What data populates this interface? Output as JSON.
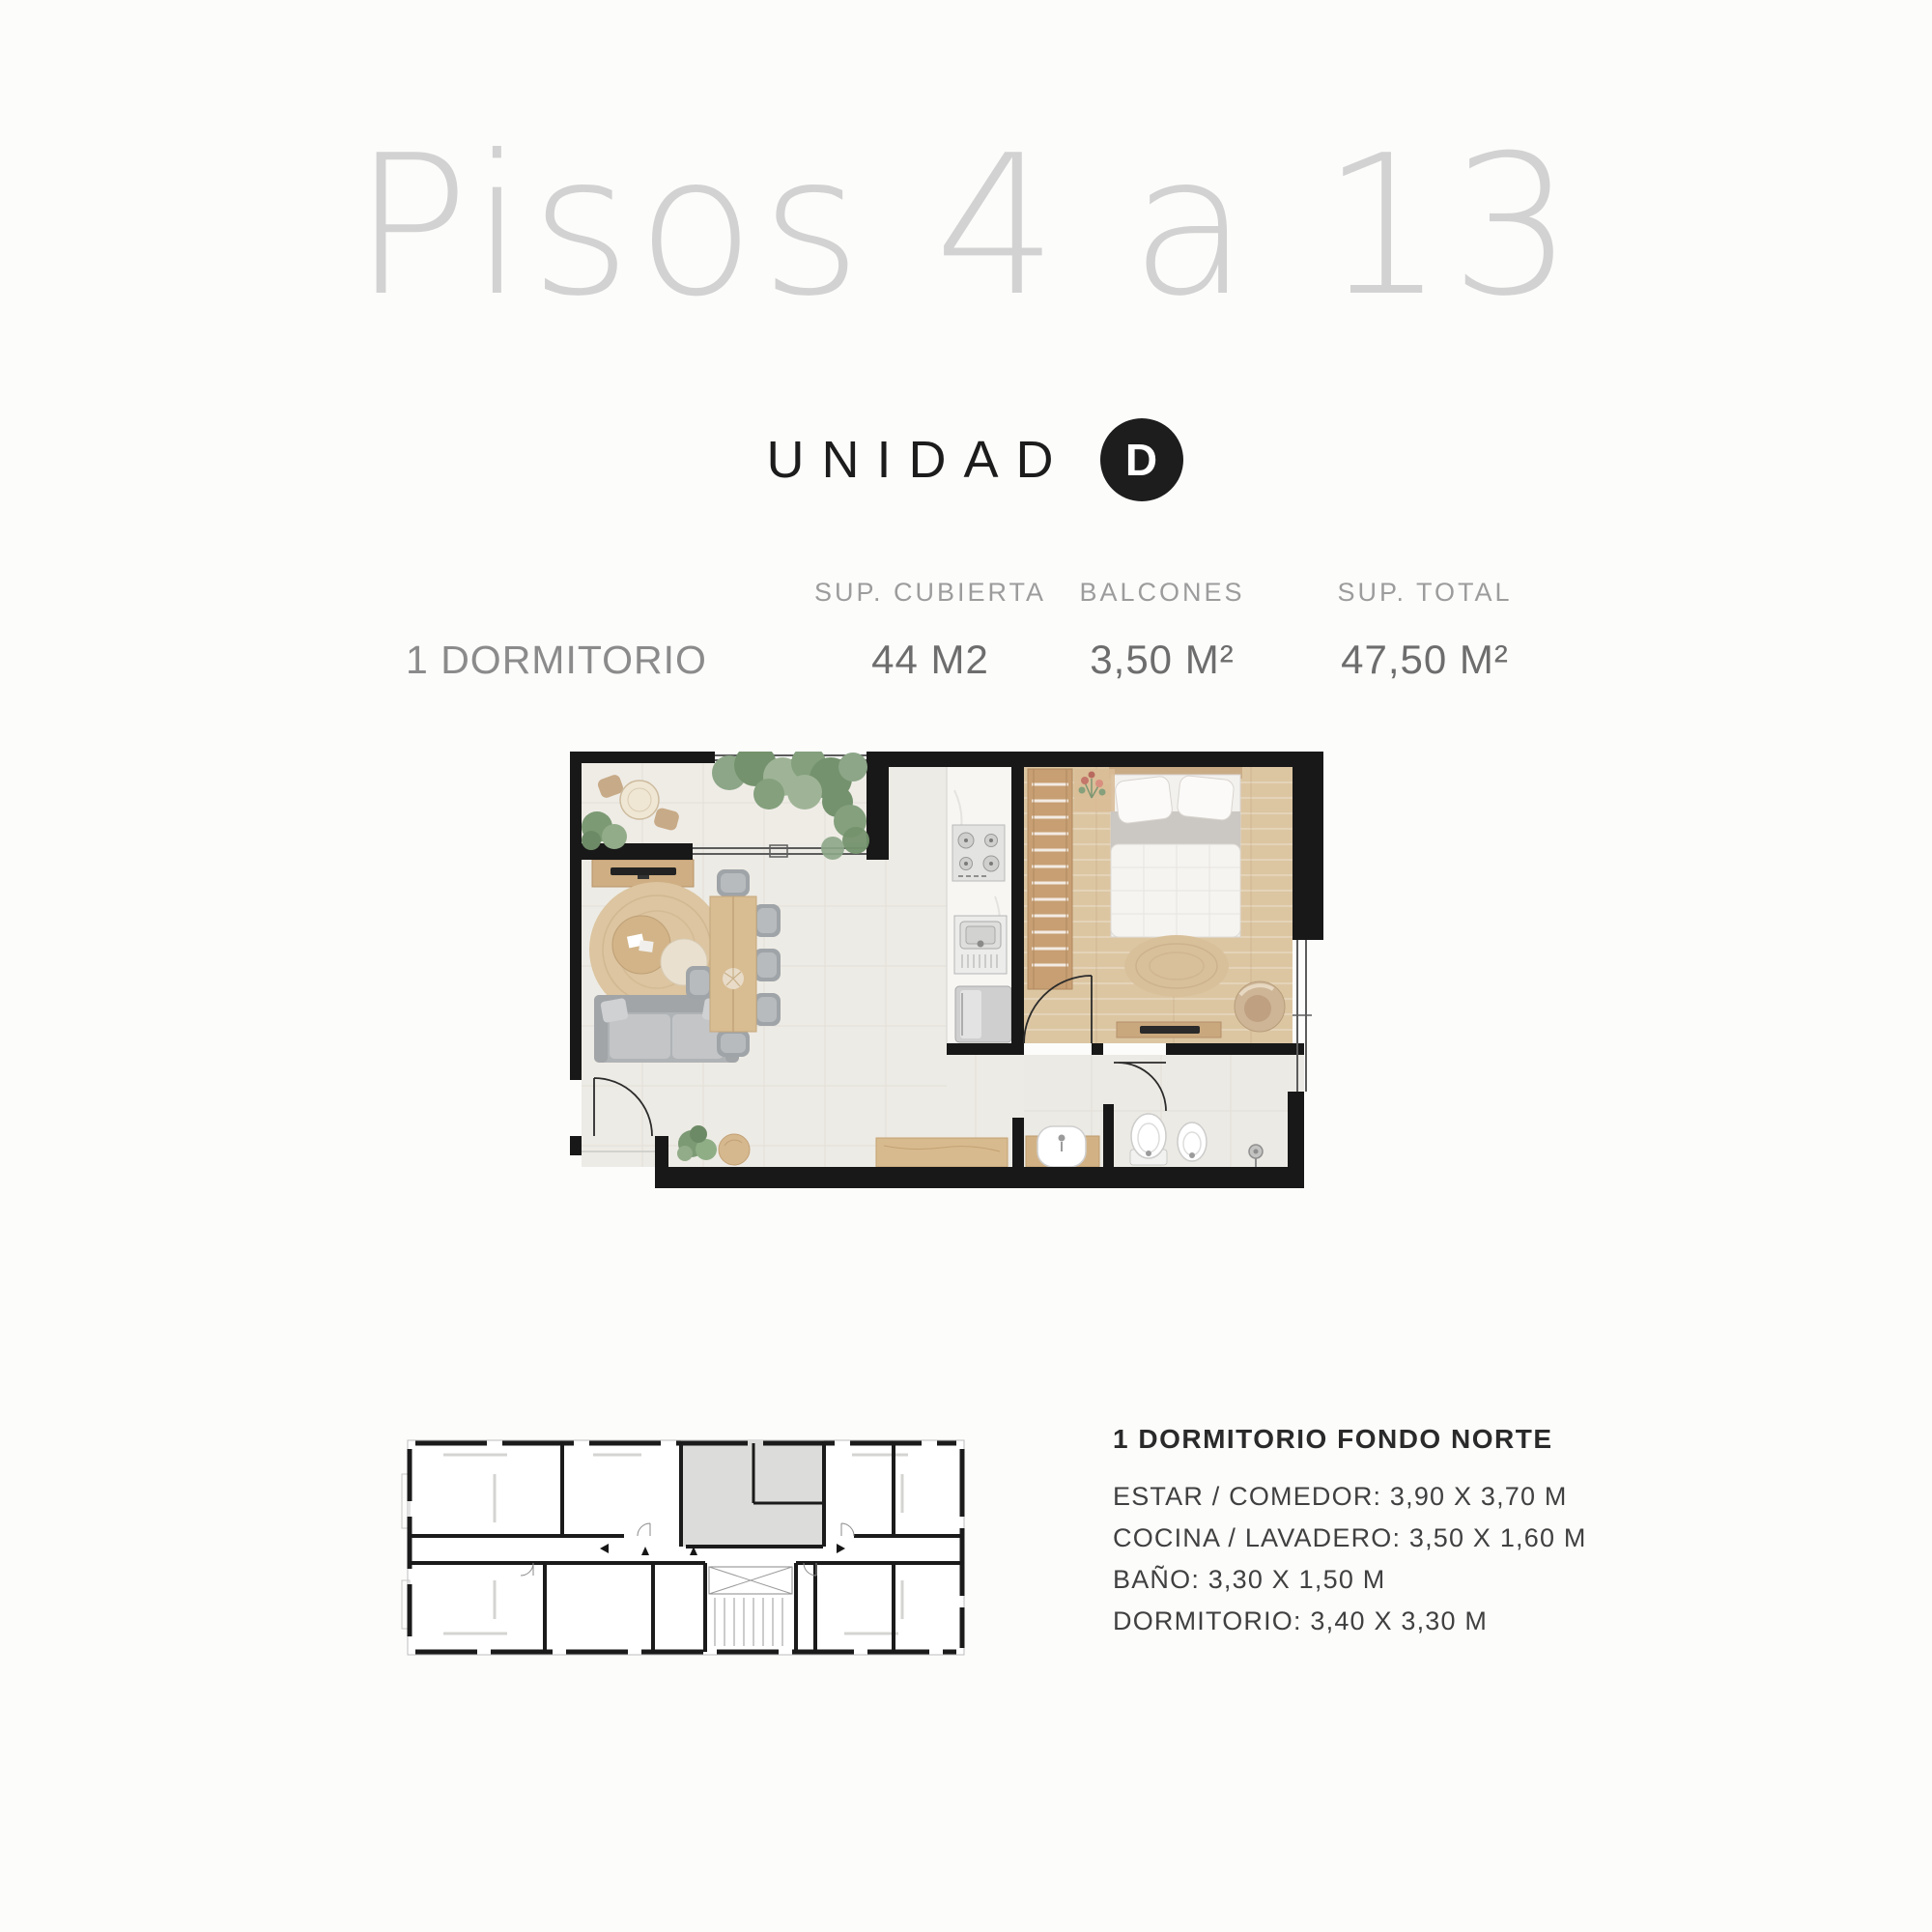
{
  "title": "Pisos 4 a 13",
  "unit": {
    "label": "UNIDAD",
    "letter": "D"
  },
  "specs": {
    "row_label": "1 DORMITORIO",
    "columns": [
      {
        "header": "SUP. CUBIERTA",
        "value": "44 M2"
      },
      {
        "header": "BALCONES",
        "value": "3,50 M²"
      },
      {
        "header": "SUP. TOTAL",
        "value": "47,50 M²"
      }
    ]
  },
  "details": {
    "heading": "1 DORMITORIO FONDO NORTE",
    "lines": [
      "ESTAR / COMEDOR: 3,90 X 3,70 M",
      "COCINA / LAVADERO: 3,50 X 1,60 M",
      "BAÑO: 3,30 X 1,50 M",
      "DORMITORIO: 3,40 X 3,30 M"
    ]
  },
  "colors": {
    "page_background": "#fcfcfb",
    "title_text": "#d2d2d2",
    "badge_background": "#1d1d1d",
    "badge_text": "#ffffff",
    "muted_text": "#9c9c9c",
    "body_text": "#3d3d3d",
    "plan_walls": "#181818",
    "plan_tile_floor": "#edebe5",
    "plan_wood_floor": "#dcc6a2",
    "keyplan_highlight": "#dcdcda"
  }
}
